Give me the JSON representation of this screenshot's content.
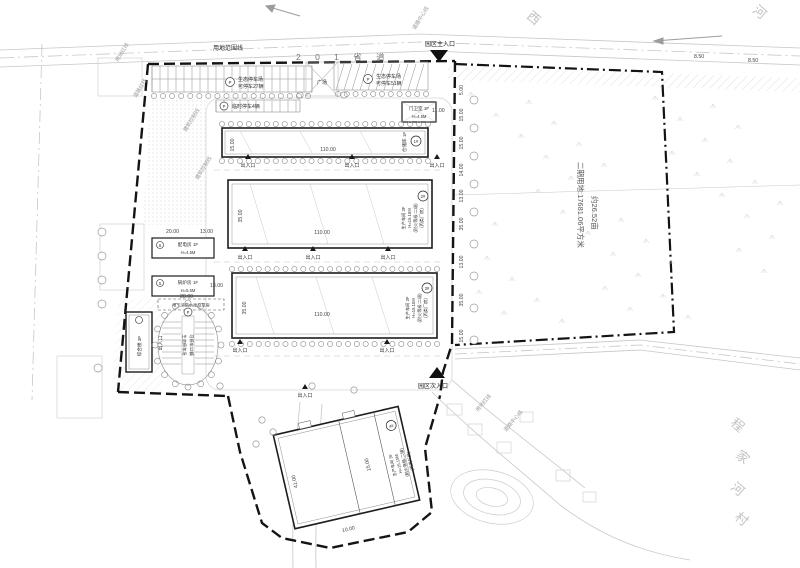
{
  "roads": {
    "r201": "2 0 1 省 道"
  },
  "lines": {
    "site_label": "用地范围线",
    "red": "用地红线",
    "road_red": "道路红线",
    "ctrl": "建筑控制线",
    "center": "道路中心线"
  },
  "entrances": {
    "main": "园区主入口",
    "secondary": "园区次入口",
    "gate": "出入口"
  },
  "parking": {
    "p": "P",
    "eco": "生态停车场",
    "n27": "可停车27辆",
    "n51": "可停车51辆",
    "n12": "可停车12辆",
    "temp": "临时停车4辆"
  },
  "plaza": "广场",
  "buildings": {
    "b1": {
      "no": "1#",
      "name": "仓储库 1F",
      "len": "110.00"
    },
    "b2": {
      "no": "2#",
      "name": "生产车间 3F",
      "h": "H=15.15M",
      "fire": "(耐火等级:二级)",
      "cls": "(丙类厂房)",
      "len": "110.00"
    },
    "b3": {
      "no": "3#",
      "name": "生产车间 3F",
      "h": "H=15.15M",
      "fire": "(耐火等级:二级)",
      "cls": "(丙类厂房)",
      "len": "110.00"
    },
    "b4": {
      "no": "4#",
      "name": "生产车间 3F",
      "h": "H=15.15M",
      "fire": "(耐火等级:二级)",
      "cls": "(丙类厂房)"
    },
    "power": {
      "no": "6",
      "name": "配电房 1F",
      "h": "H=4.5M"
    },
    "boiler": {
      "no": "5",
      "name": "锅炉房 1F",
      "h": "H=5.5M"
    },
    "complex": {
      "name": "综合楼 3F"
    },
    "guard": {
      "name": "门卫室 1F",
      "h": "H=4.5M"
    },
    "pump": "地下消防水池及泵房"
  },
  "phase2": {
    "l1": "二期用地:17681.06平方米",
    "l2": "约26.52亩"
  },
  "context": {
    "village_chars": [
      "程",
      "家",
      "河",
      "村"
    ],
    "river": "河",
    "west": "西"
  },
  "dims": {
    "d110": "110.00",
    "d35": "35.00",
    "d20": "20.00",
    "d13": "13.00",
    "d15": "15.00",
    "d14": "14.00",
    "d28": "28.00",
    "d41": "41.00",
    "d11": "11.00",
    "d5": "5.00",
    "d85": "8.50",
    "d10": "10.00"
  }
}
